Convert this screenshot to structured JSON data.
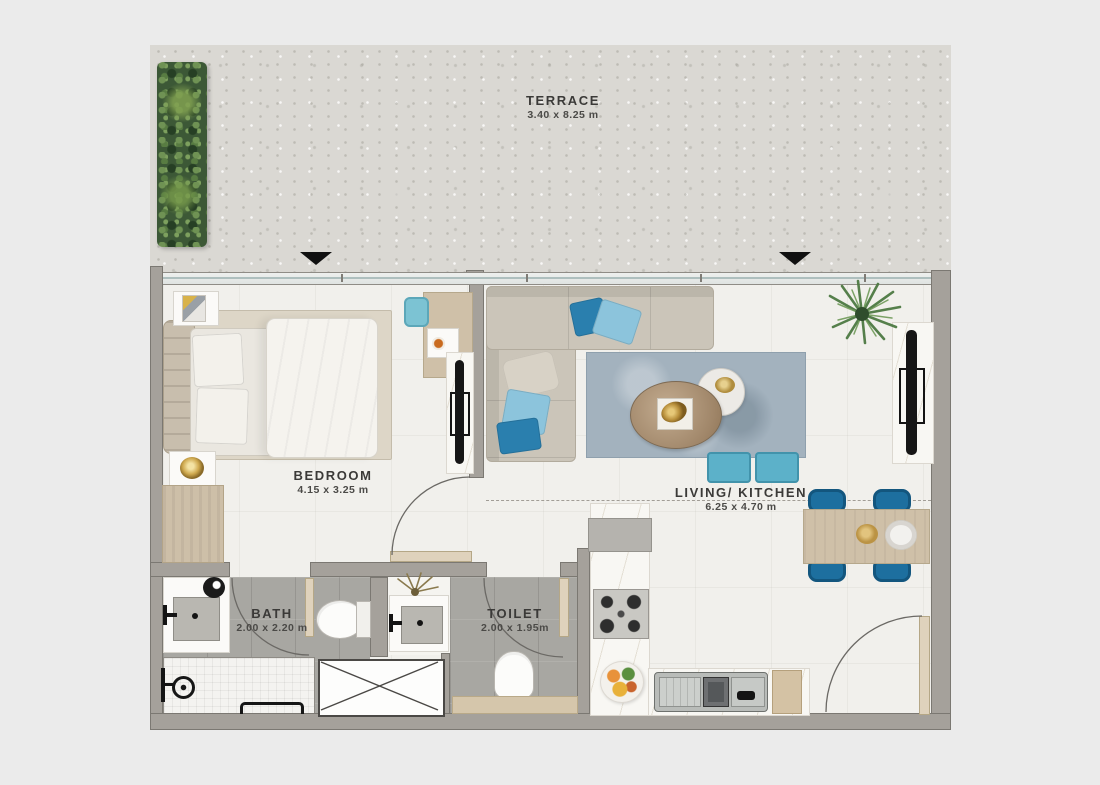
{
  "rooms": {
    "terrace": {
      "name": "TERRACE",
      "dims": "3.40 x 8.25 m"
    },
    "bedroom": {
      "name": "BEDROOM",
      "dims": "4.15 x 3.25 m"
    },
    "living_kitchen": {
      "name": "LIVING/ KITCHEN",
      "dims": "6.25 x 4.70 m"
    },
    "bath": {
      "name": "BATH",
      "dims": "2.00 x 2.20 m"
    },
    "toilet": {
      "name": "TOILET",
      "dims": "2.00 x 1.95m"
    }
  },
  "markers": {
    "entrance_arrow_glyph": "▼",
    "entrance_arrow_count": 2
  },
  "colors": {
    "background": "#ebebeb",
    "terrace_floor": "#dad8d3",
    "interior_floor": "#f1f0ec",
    "wet_room_floor": "#a8a7a2",
    "wall": "#a5a19b",
    "door_wood": "#dfd2bc",
    "wood": "#cfc0a8",
    "sofa": "#cbc5b9",
    "rug_living": "#a3b2be",
    "rug_bedroom": "#ddd6c7",
    "accent_blue": "#2a7fae",
    "accent_teal": "#5cb1c9",
    "plant_green": "#4d7a43",
    "label_text": "#3b3a38"
  }
}
